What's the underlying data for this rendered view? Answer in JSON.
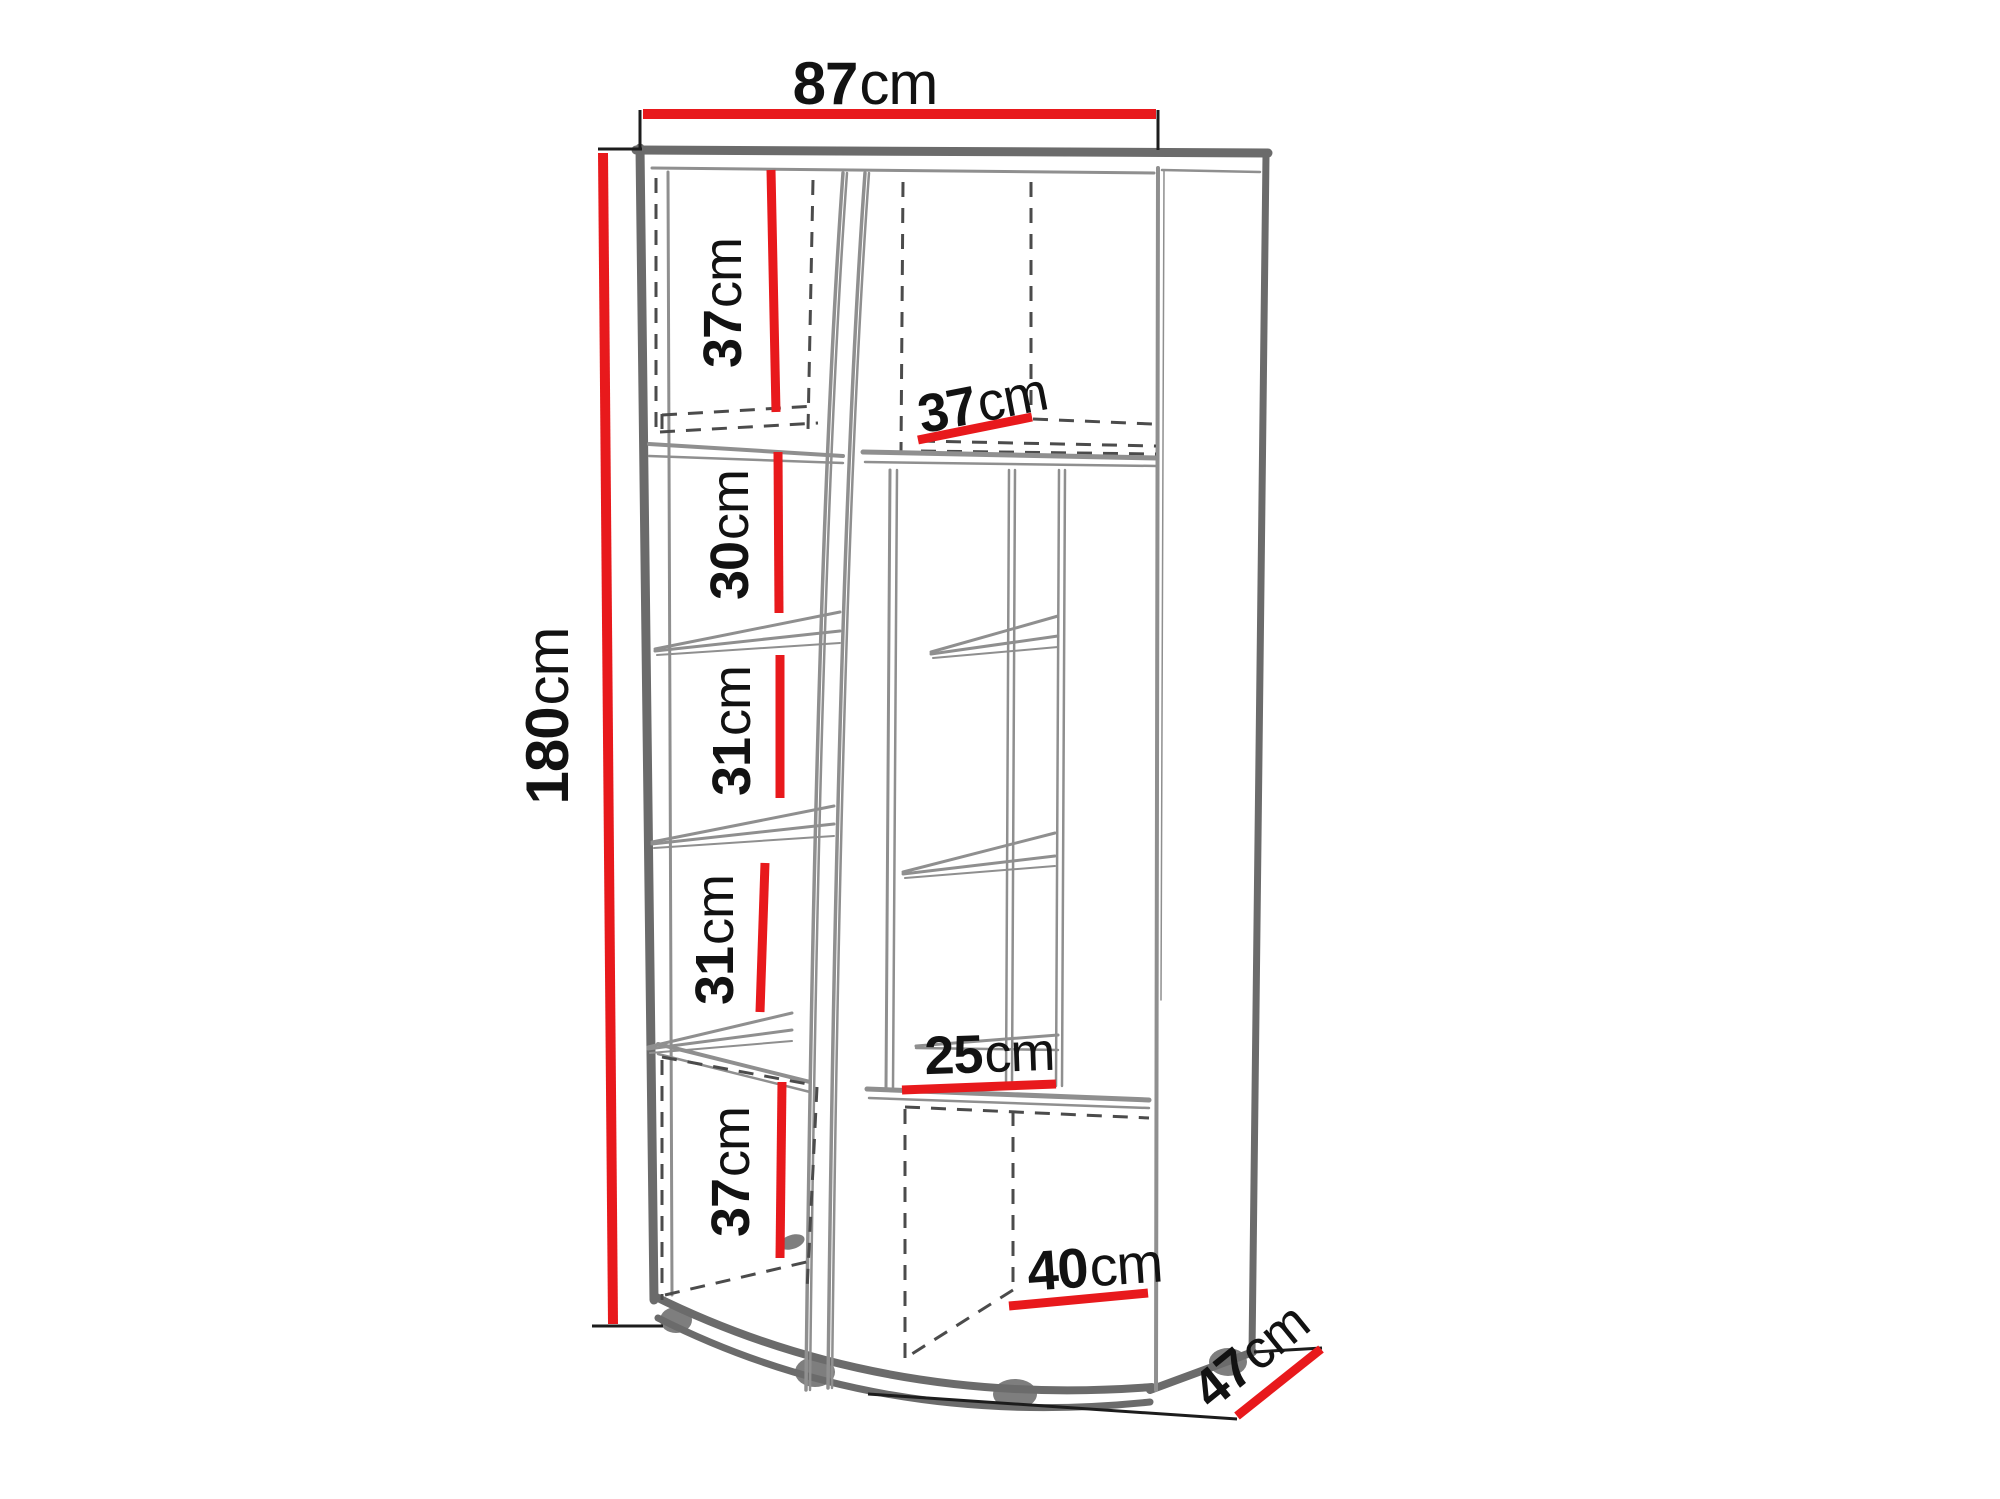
{
  "diagram": {
    "name": "corner-cabinet-dimension-drawing",
    "description": "Technical line drawing of a tall corner display cabinet with overall and internal shelf dimensions",
    "unit": "cm"
  },
  "colors": {
    "dimension_red": "#e8191c",
    "outline_gray": "#6b6b6b",
    "thin_gray": "#8f8f8f",
    "dashed_gray": "#4b4b4b",
    "tick_black": "#1c1c1c",
    "text_black": "#121212",
    "foot_gray": "#7e7e7e",
    "background": "#ffffff"
  },
  "measurements": {
    "width": {
      "num": "87",
      "unit": "cm"
    },
    "height": {
      "num": "180",
      "unit": "cm"
    },
    "depth": {
      "num": "47",
      "unit": "cm"
    },
    "left_sections": [
      {
        "num": "37",
        "unit": "cm"
      },
      {
        "num": "30",
        "unit": "cm"
      },
      {
        "num": "31",
        "unit": "cm"
      },
      {
        "num": "31",
        "unit": "cm"
      },
      {
        "num": "37",
        "unit": "cm"
      }
    ],
    "right_top_shelf_depth": {
      "num": "37",
      "unit": "cm"
    },
    "right_middle_shelf_depth": {
      "num": "25",
      "unit": "cm"
    },
    "right_bottom_width": {
      "num": "40",
      "unit": "cm"
    }
  }
}
